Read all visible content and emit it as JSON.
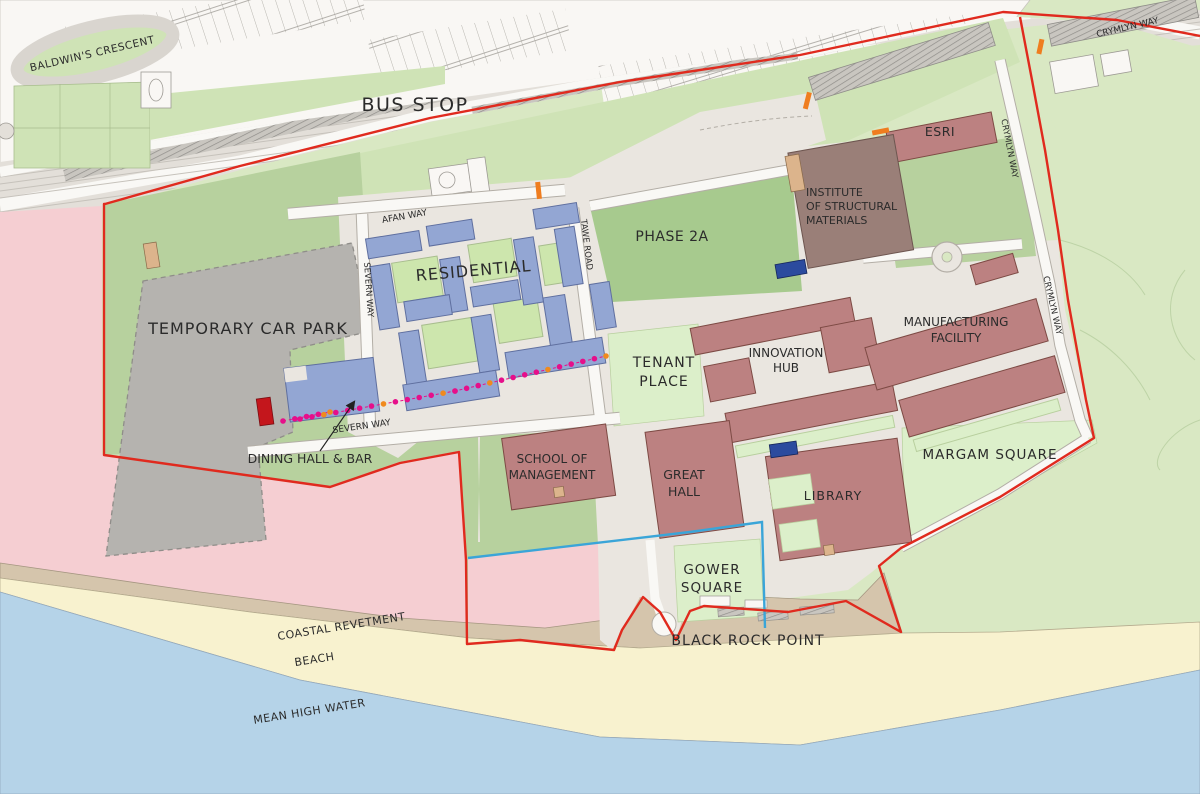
{
  "map": {
    "colors": {
      "bg_green": "#d9e8c3",
      "green_strip": "#cfe3b6",
      "green_mid": "#b7d19e",
      "green_dark": "#a7ca8e",
      "lawn_pale": "#dcefca",
      "courtyard_green": "#cde6ad",
      "paving": "#eae6e0",
      "road_white": "#f9f8f5",
      "road_stroke": "#b3aea6",
      "carpark_gray": "#b5b3af",
      "urban_white": "#f9f7f4",
      "urban_stroke": "#9d9a94",
      "water": "#b5d3e8",
      "beach": "#f8f2cf",
      "revetment": "#d5c5ac",
      "pink": "#f5ced2",
      "building_red": "#bc8181",
      "building_red_stroke": "#7d4a44",
      "building_brown": "#9a7f78",
      "building_brown_stroke": "#6e5650",
      "residential_blue": "#93a6d3",
      "residential_blue_stroke": "#5f6f9f",
      "feature_blue": "#2b4b9e",
      "feature_dark_red": "#c4161c",
      "tan_feature": "#dcb48c",
      "boundary_red": "#e02a1e",
      "boundary_cyan": "#3aa5d8",
      "route_magenta": "#e60f8a",
      "route_orange": "#f08a1e",
      "gate_orange": "#ef7d1f",
      "label_dark": "#2b2b2b"
    },
    "labels": {
      "baldwins_crescent": "BALDWIN'S CRESCENT",
      "bus_stop": "BUS STOP",
      "crymlyn_top": "CRYMLYN WAY",
      "crymlyn_upper": "CRYMLYN WAY",
      "crymlyn_lower": "CRYMLYN WAY",
      "afan_way": "AFAN WAY",
      "tawe_road": "TAWE ROAD",
      "severn_way_v": "SEVERN WAY",
      "severn_way_h": "SEVERN WAY",
      "esri": "ESRI",
      "ism_1": "INSTITUTE",
      "ism_2": "OF STRUCTURAL",
      "ism_3": "MATERIALS",
      "phase_2a": "PHASE 2A",
      "residential": "RESIDENTIAL",
      "temporary_car_park": "TEMPORARY CAR PARK",
      "tenant_1": "TENANT",
      "tenant_2": "PLACE",
      "innovation_1": "INNOVATION",
      "innovation_2": "HUB",
      "manufacturing_1": "MANUFACTURING",
      "manufacturing_2": "FACILITY",
      "margam_square": "MARGAM SQUARE",
      "dining_hall": "DINING HALL & BAR",
      "school_1": "SCHOOL OF",
      "school_2": "MANAGEMENT",
      "great_1": "GREAT",
      "great_2": "HALL",
      "library": "LIBRARY",
      "gower_1": "GOWER",
      "gower_2": "SQUARE",
      "black_rock_point": "BLACK ROCK POINT",
      "coastal_revetment": "COASTAL REVETMENT",
      "beach": "BEACH",
      "mean_high_water": "MEAN HIGH WATER"
    },
    "route": {
      "dot_colors": {
        "primary": "#e60f8a",
        "accent": "#f08a1e"
      },
      "accent_every": 5
    }
  }
}
